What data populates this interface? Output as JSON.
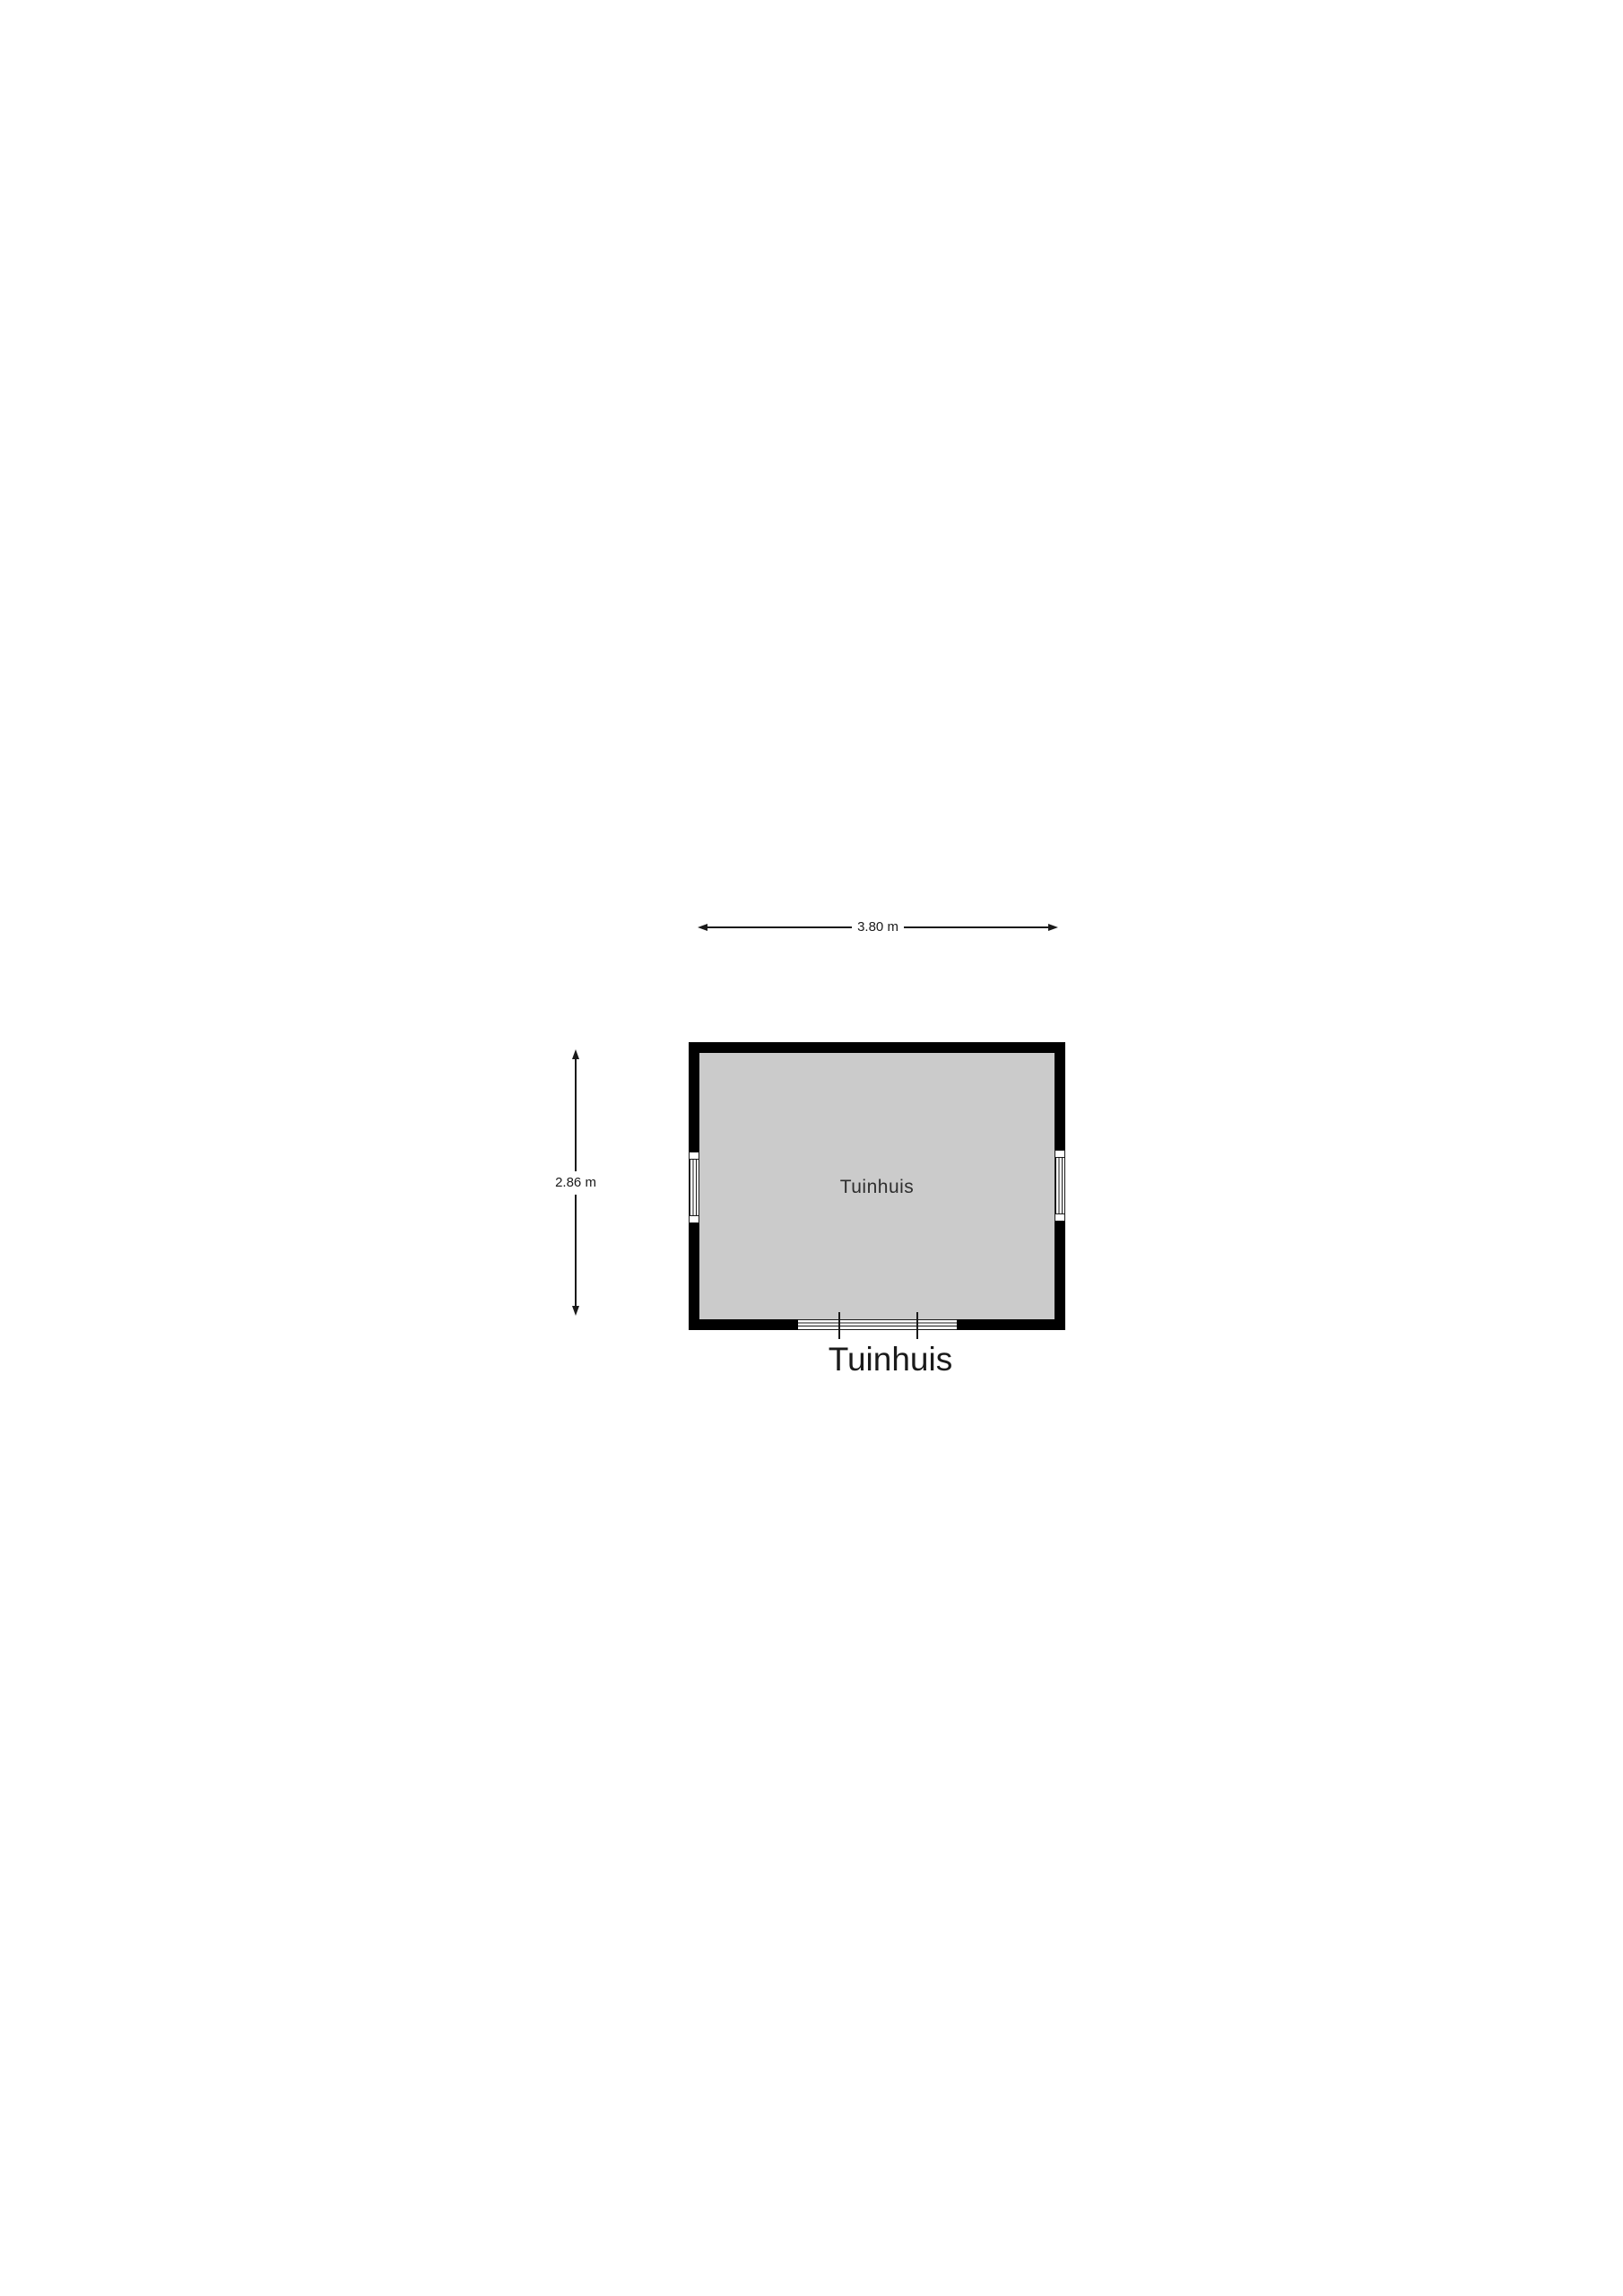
{
  "floorplan": {
    "title": "Tuinhuis",
    "room": {
      "label": "Tuinhuis"
    },
    "dimensions": {
      "width": "3.80 m",
      "height": "2.86 m"
    },
    "colors": {
      "wall": "#000000",
      "floor": "#cbcbcb",
      "line": "#1a1a1a",
      "background": "#ffffff"
    }
  }
}
